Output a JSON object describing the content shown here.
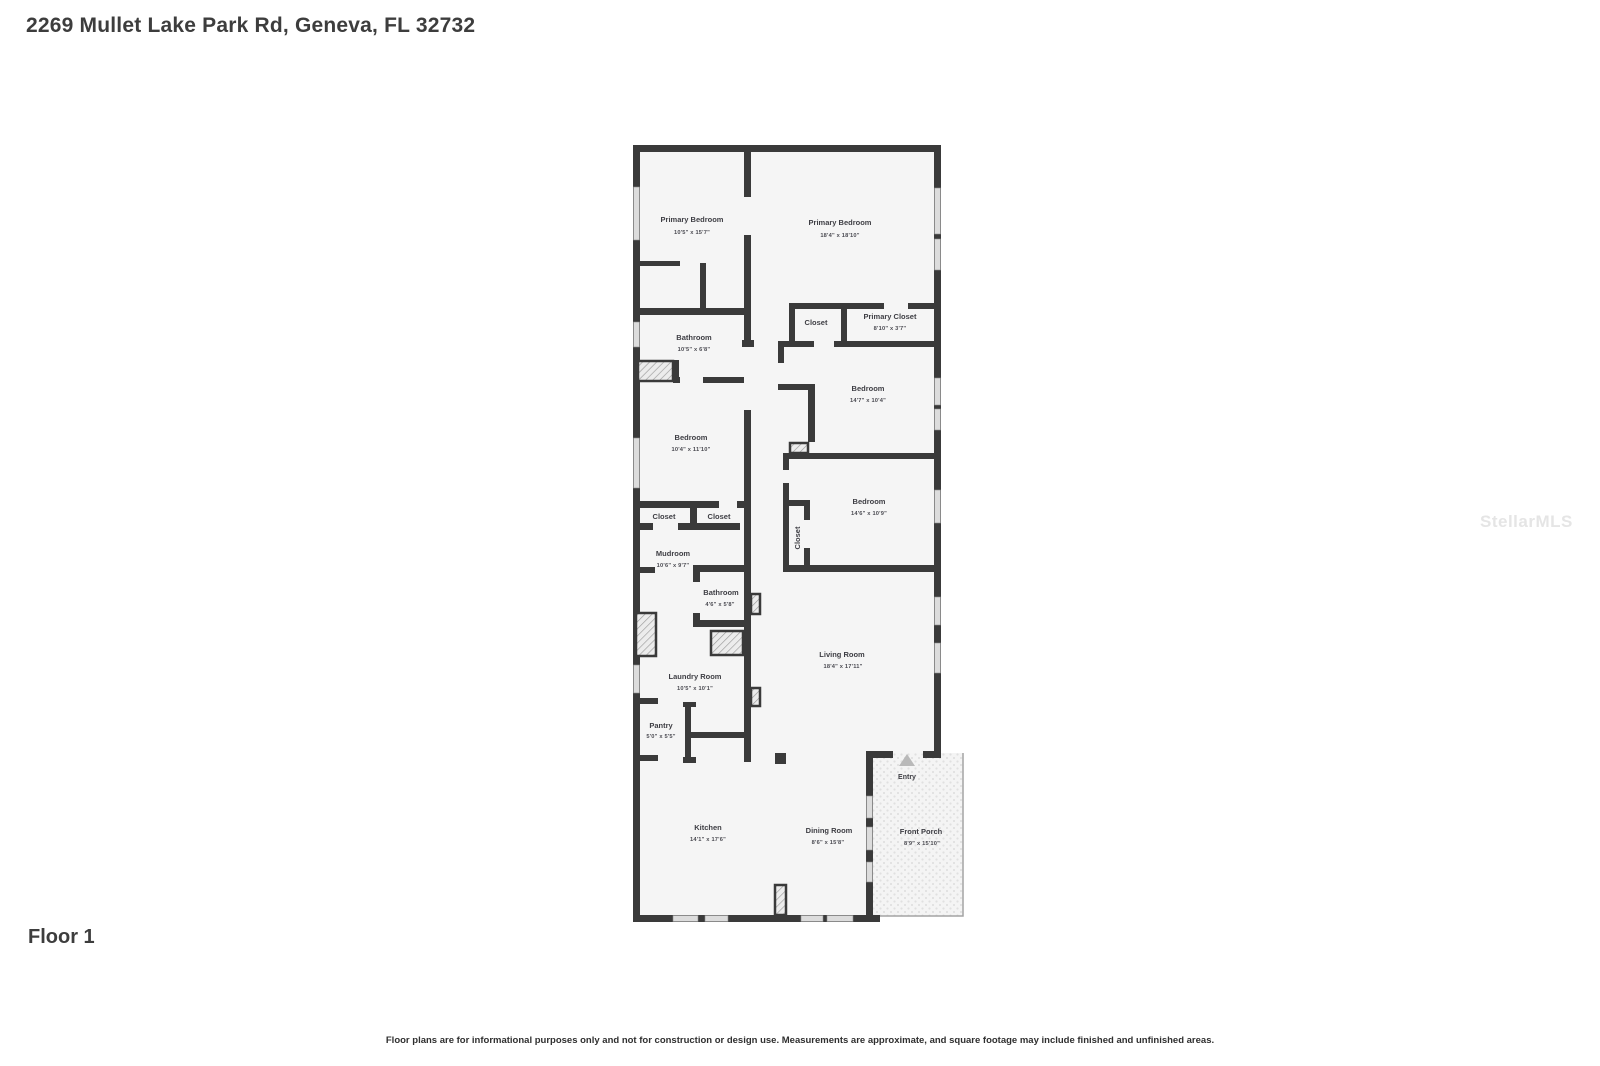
{
  "page": {
    "title": "2269 Mullet Lake Park Rd, Geneva, FL 32732",
    "floor_label": "Floor 1",
    "disclaimer": "Floor plans are for informational purposes only and not for construction or design use. Measurements are approximate, and square footage may include finished and unfinished areas.",
    "watermark": "StellarMLS"
  },
  "floorplan": {
    "colors": {
      "wall": "#3a3a3a",
      "floor": "#f5f5f5",
      "window": "#dcdcdc",
      "entry_arrow": "#b9b9b9"
    },
    "entry_label": "Entry",
    "rooms": [
      {
        "name": "Primary Bedroom",
        "dims": "10'5\" x 15'7\""
      },
      {
        "name": "Primary Bedroom",
        "dims": "18'4\" x 18'10\""
      },
      {
        "name": "Closet",
        "dims": ""
      },
      {
        "name": "Primary Closet",
        "dims": "8'10\" x 3'7\""
      },
      {
        "name": "Bathroom",
        "dims": "10'5\" x 6'8\""
      },
      {
        "name": "Bedroom",
        "dims": "14'7\" x 10'4\""
      },
      {
        "name": "Bedroom",
        "dims": "10'4\" x 11'10\""
      },
      {
        "name": "Closet",
        "dims": ""
      },
      {
        "name": "Closet",
        "dims": ""
      },
      {
        "name": "Bedroom",
        "dims": "14'6\" x 10'9\""
      },
      {
        "name": "Closet",
        "dims": ""
      },
      {
        "name": "Mudroom",
        "dims": "10'6\" x 9'7\""
      },
      {
        "name": "Bathroom",
        "dims": "4'6\" x 5'8\""
      },
      {
        "name": "Living Room",
        "dims": "18'4\" x 17'11\""
      },
      {
        "name": "Laundry Room",
        "dims": "10'5\" x 10'1\""
      },
      {
        "name": "Pantry",
        "dims": "5'0\" x 5'5\""
      },
      {
        "name": "Kitchen",
        "dims": "14'1\" x 17'6\""
      },
      {
        "name": "Dining Room",
        "dims": "8'6\" x 15'8\""
      },
      {
        "name": "Front Porch",
        "dims": "8'9\" x 15'10\""
      }
    ]
  }
}
